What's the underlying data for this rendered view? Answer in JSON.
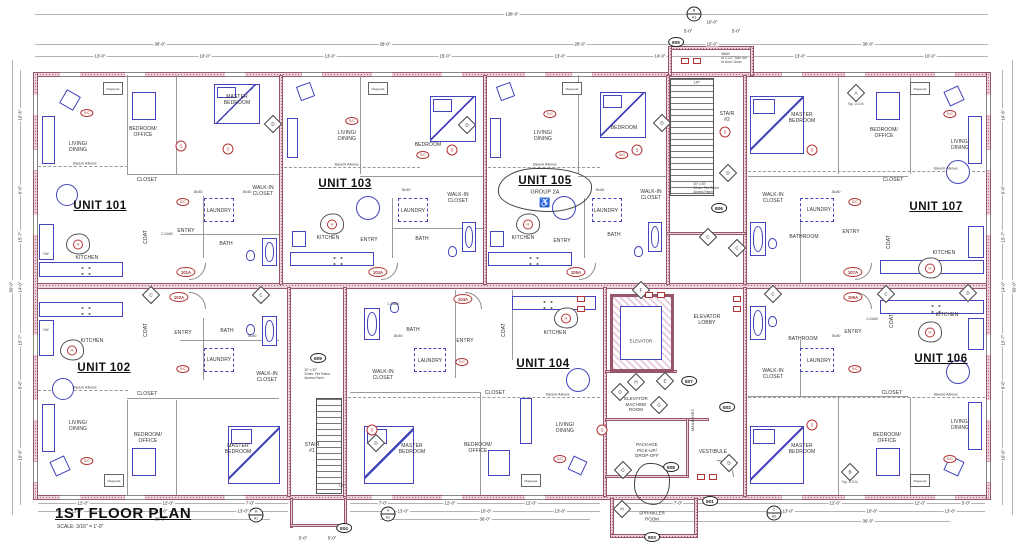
{
  "colors": {
    "wall_fill": "#ecd3dd",
    "wall_edge": "#96566b",
    "furniture_blue": "#4444bb",
    "annotation_red": "#b03434",
    "line_gray": "#888888",
    "text_dark": "#333333"
  },
  "title": {
    "name": "1ST FLOOR PLAN",
    "scale": "SCALE: 3/16\" = 1'-0\""
  },
  "units": [
    {
      "id": "101",
      "label": "UNIT 101",
      "tag": "101A",
      "rooms": [
        "LIVING/\nDINING",
        "BEDROOM/\nOFFICE",
        "MASTER\nBEDROOM",
        "CLOSET",
        "WALK-IN\nCLOSET",
        "LAUNDRY",
        "ENTRY",
        "BATH",
        "KITCHEN",
        "COAT"
      ]
    },
    {
      "id": "102",
      "label": "UNIT 102",
      "tag": "102A",
      "rooms": [
        "LIVING/\nDINING",
        "BEDROOM/\nOFFICE",
        "MASTER\nBEDROOM",
        "CLOSET",
        "WALK-IN\nCLOSET",
        "LAUNDRY",
        "ENTRY",
        "BATH",
        "KITCHEN",
        "COAT"
      ]
    },
    {
      "id": "103",
      "label": "UNIT 103",
      "tag": "103A",
      "rooms": [
        "LIVING/\nDINING",
        "BEDROOM",
        "WALK-IN\nCLOSET",
        "LAUNDRY",
        "KITCHEN",
        "ENTRY",
        "BATH"
      ]
    },
    {
      "id": "104",
      "label": "UNIT 104",
      "tag": "104A",
      "rooms": [
        "LIVING/\nDINING",
        "KITCHEN",
        "MASTER\nBEDROOM",
        "BEDROOM/\nOFFICE",
        "WALK-IN\nCLOSET",
        "LAUNDRY",
        "BATH",
        "ENTRY",
        "COAT",
        "CLOSET"
      ]
    },
    {
      "id": "105",
      "label": "UNIT 105",
      "tag": "105A",
      "group": "GROUP 2A",
      "accessible_icon": "♿",
      "rooms": [
        "LIVING/\nDINING",
        "BEDROOM",
        "WALK-IN\nCLOSET",
        "LAUNDRY",
        "KITCHEN",
        "ENTRY",
        "BATH"
      ]
    },
    {
      "id": "106",
      "label": "UNIT 106",
      "tag": "106A",
      "rooms": [
        "LIVING/\nDINING",
        "BEDROOM/\nOFFICE",
        "MASTER\nBEDROOM",
        "CLOSET",
        "WALK-IN\nCLOSET",
        "LAUNDRY",
        "ENTRY",
        "BATHROOM",
        "KITCHEN",
        "COAT"
      ]
    },
    {
      "id": "107",
      "label": "UNIT 107",
      "tag": "107A",
      "rooms": [
        "LIVING/\nDINING",
        "BEDROOM/\nOFFICE",
        "MASTER\nBEDROOM",
        "CLOSET",
        "WALK-IN\nCLOSET",
        "LAUNDRY",
        "ENTRY",
        "BATHROOM",
        "KITCHEN",
        "COAT"
      ]
    }
  ],
  "core": {
    "stair1": "STAIR\n#1",
    "stair2": "STAIR\n#2",
    "up": "UP",
    "elevator": "ELEVATOR",
    "elevator_lobby": "ELEVATOR\nLOBBY",
    "machine_room": "ELEVATOR\nMACHINE\nROOM",
    "package": "PACKAGE\nPICK-UP/\nDROP-OFF",
    "vestibule": "VESTIBULE",
    "sprinkler": "SPRINKLER\nROOM",
    "mailboxes": "MAILBOXES"
  },
  "annotations": {
    "beam_above": "Beam Above",
    "typ_uon": "Typ. U.O.N.",
    "door_36": "36x80",
    "door_2_24": "2-24x80",
    "dw": "DW",
    "magiepak": "Magiepak",
    "sidelite_note": "36x80\nw/ 2-1/2\" Side Lite\nw/ Auto Closer",
    "access_panel": "30\" x 30\"\n20min. Fire Rated\nAccess Panel"
  },
  "markers": {
    "a": "A",
    "b": "B",
    "c": "C",
    "d": "D",
    "e": "E",
    "f": "F",
    "g": "G",
    "h": "H",
    "s": "S",
    "sc": "S/C",
    "hood": "H"
  },
  "callouts": {
    "e01": "E01",
    "e02": "E02",
    "e03": "E03",
    "e04": "E04",
    "e05": "E05",
    "e06": "E06",
    "e07": "E07",
    "e08": "E08",
    "e09": "E09"
  },
  "ref_circles": [
    {
      "top": "A",
      "bottom": "A1"
    },
    {
      "top": "A",
      "bottom": "A1"
    },
    {
      "top": "C",
      "bottom": "A2"
    },
    {
      "top": "B",
      "bottom": "A1"
    }
  ],
  "dims": {
    "overall_top": "138'-0\"",
    "overall_left": "60'-0\"",
    "overall_right": "60'-0\"",
    "top_row2": [
      "36'-0\"",
      "28'-0\"",
      "28'-0\"",
      "10'-0\"",
      "36'-0\""
    ],
    "top_row3": [
      "13'-0\"",
      "10'-0\"",
      "13'-0\"",
      "15'-0\"",
      "13'-0\"",
      "14'-0\"",
      "13'-0\"",
      "10'-0\""
    ],
    "stair2_top": [
      "5'-0\"",
      "5'-0\""
    ],
    "stair2_width": "10'-0\"",
    "left": [
      "16'-6\"",
      "6'-6\"",
      "15'-7\"",
      "14'-0\"",
      "15'-7\"",
      "6'-6\"",
      "16'-6\""
    ],
    "right": [
      "16'-6\"",
      "6'-6\"",
      "15'-7\"",
      "14'-0\"",
      "15'-7\"",
      "6'-6\"",
      "16'-6\""
    ],
    "bottom_left_row1": [
      "12'-0\"",
      "12'-0\"",
      "7'-0\""
    ],
    "bottom_left_row2": [
      "13'-0\"",
      "10'-0\"",
      "13'-0\""
    ],
    "bottom_left_total": "36'-0\"",
    "mid_row1": [
      "7'-0\"",
      "12'-0\"",
      "12'-0\""
    ],
    "mid_row2": [
      "13'-0\"",
      "10'-0\"",
      "13'-0\""
    ],
    "mid_total": "36'-0\"",
    "bottom_right_row1": [
      "7'-0\"",
      "12'-0\"",
      "12'-0\"",
      "5'-0\""
    ],
    "bottom_right_row2": [
      "13'-0\"",
      "10'-0\"",
      "13'-0\""
    ],
    "bottom_right_total": "36'-0\"",
    "stair1_bottom": [
      "5'-0\"",
      "5'-0\""
    ]
  }
}
